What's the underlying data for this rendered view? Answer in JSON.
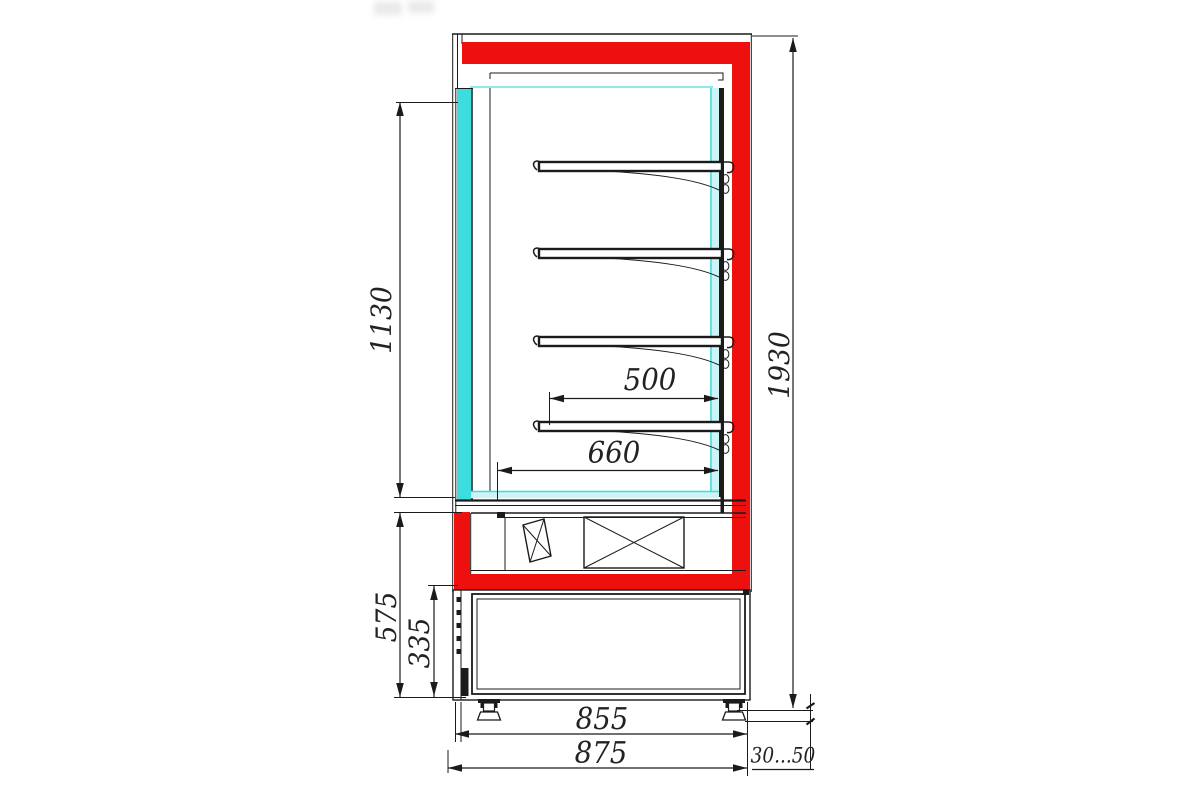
{
  "drawing": {
    "description": "Side cross-section technical drawing of a refrigerated wall display case with four shelves, glass front, fan compartment and base unit on adjustable feet",
    "shelf_count": 4
  },
  "colors": {
    "frame_red": "#ee0f0f",
    "glass_cyan": "#3ddcdf",
    "glass_cyan_pale": "#cdf4f5",
    "line_ink": "#1b1b1b",
    "background": "#ffffff"
  },
  "dimensions": {
    "interior_height": "1130",
    "overall_height": "1930",
    "shelf_depth": "500",
    "interior_depth": "660",
    "base_section_height": "575",
    "base_inner_height": "335",
    "base_width": "855",
    "overall_depth": "875",
    "wall_clearance": "30...50"
  }
}
